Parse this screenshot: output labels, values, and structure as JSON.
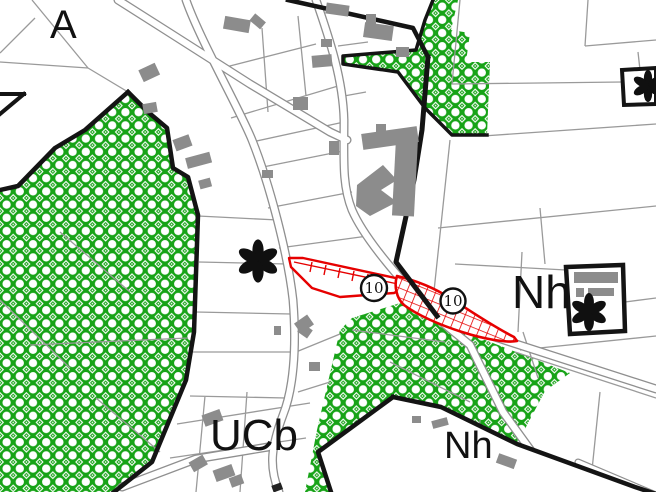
{
  "map": {
    "zone_labels": {
      "a": "A",
      "nh_east": "Nh",
      "ucb": "UCb",
      "nh_south": "Nh"
    },
    "reserved_area_badges": [
      "10",
      "10"
    ],
    "colors": {
      "wooded_area_green": "#17A317",
      "reserved_area_red": "#E60000",
      "building_gray": "#8C8C8C",
      "parcel_line_gray": "#9A9A9A",
      "boundary_black": "#141414",
      "road_fill": "#FFFFFF"
    },
    "symbols": {
      "rosette": "heritage-building-asterisk",
      "badge_circle": "reserved-plot-number"
    }
  }
}
